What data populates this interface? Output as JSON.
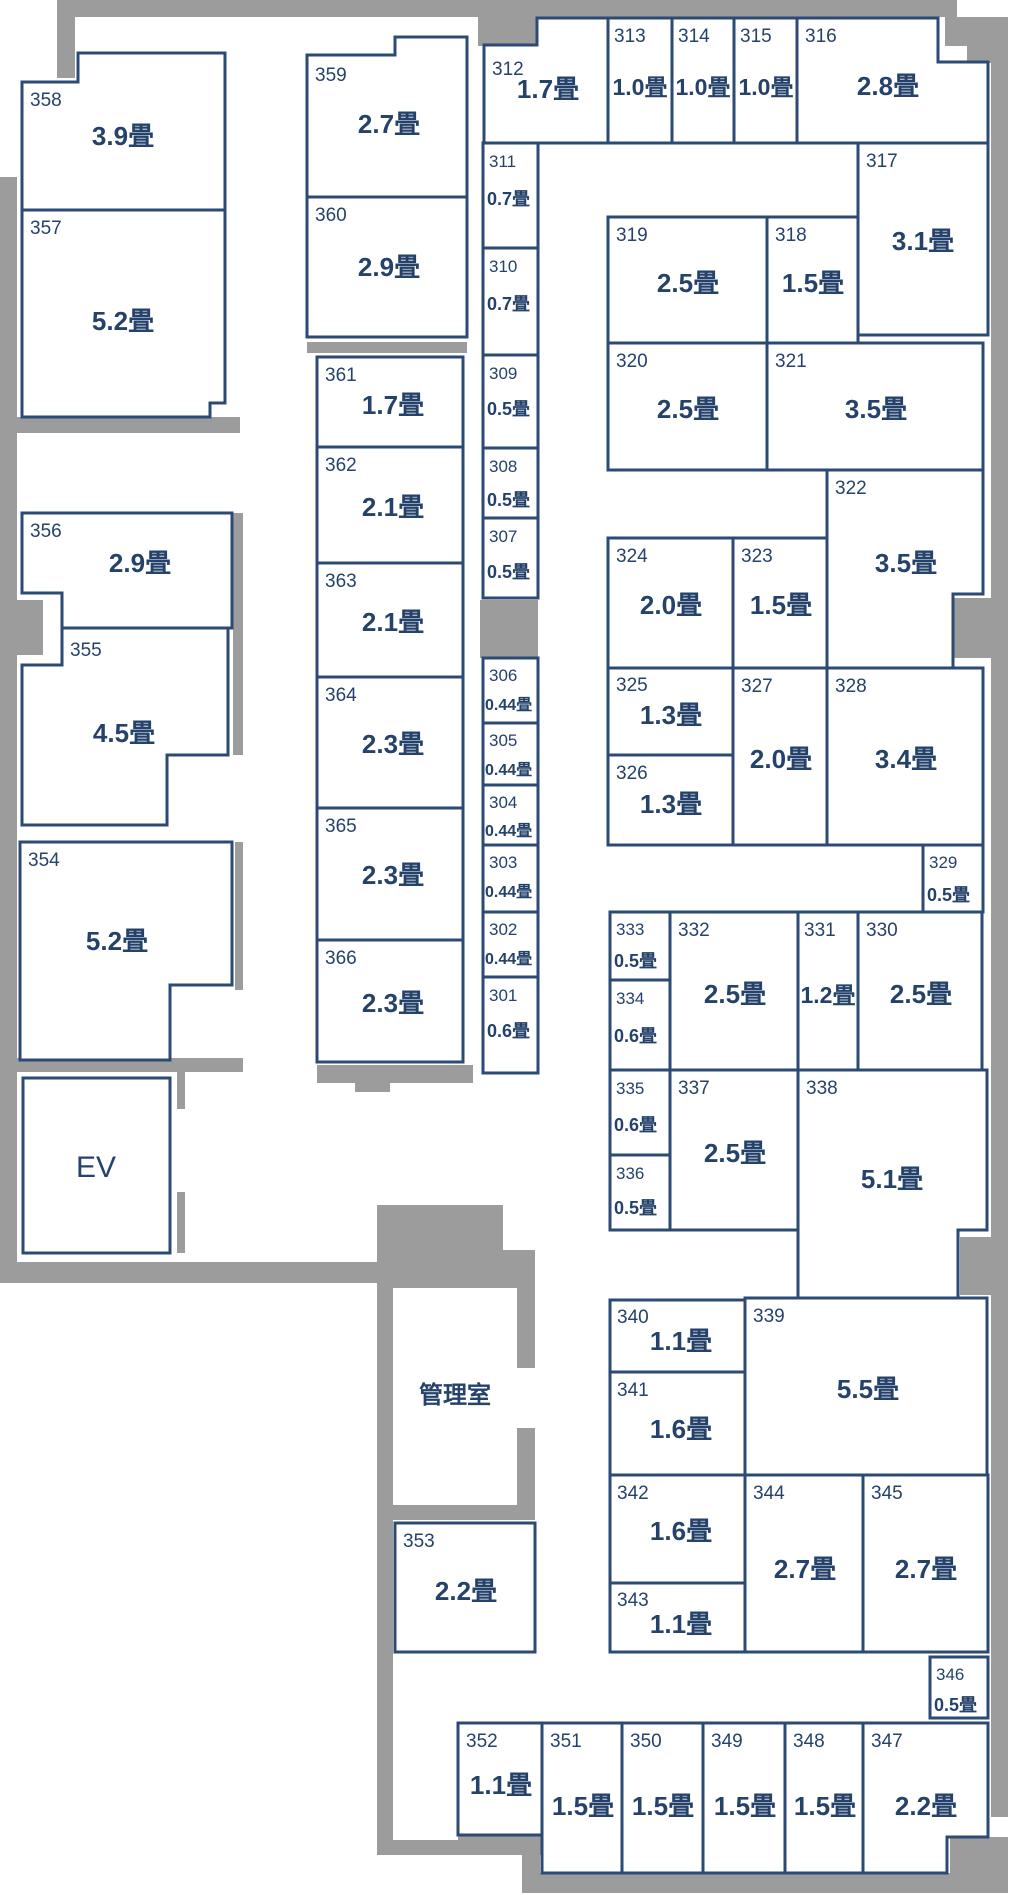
{
  "unit_suffix": "畳",
  "colors": {
    "line_navy": "#2b4a74",
    "text_navy": "#25426b",
    "wall_gray": "#9c9c9c",
    "background": "#ffffff"
  },
  "special_rooms": {
    "elevator": {
      "label": "EV"
    },
    "office": {
      "label": "管理室"
    }
  },
  "rooms": [
    {
      "id": "301",
      "size": "0.6畳"
    },
    {
      "id": "302",
      "size": "0.44畳"
    },
    {
      "id": "303",
      "size": "0.44畳"
    },
    {
      "id": "304",
      "size": "0.44畳"
    },
    {
      "id": "305",
      "size": "0.44畳"
    },
    {
      "id": "306",
      "size": "0.44畳"
    },
    {
      "id": "307",
      "size": "0.5畳"
    },
    {
      "id": "308",
      "size": "0.5畳"
    },
    {
      "id": "309",
      "size": "0.5畳"
    },
    {
      "id": "310",
      "size": "0.7畳"
    },
    {
      "id": "311",
      "size": "0.7畳"
    },
    {
      "id": "312",
      "size": "1.7畳"
    },
    {
      "id": "313",
      "size": "1.0畳"
    },
    {
      "id": "314",
      "size": "1.0畳"
    },
    {
      "id": "315",
      "size": "1.0畳"
    },
    {
      "id": "316",
      "size": "2.8畳"
    },
    {
      "id": "317",
      "size": "3.1畳"
    },
    {
      "id": "318",
      "size": "1.5畳"
    },
    {
      "id": "319",
      "size": "2.5畳"
    },
    {
      "id": "320",
      "size": "2.5畳"
    },
    {
      "id": "321",
      "size": "3.5畳"
    },
    {
      "id": "322",
      "size": "3.5畳"
    },
    {
      "id": "323",
      "size": "1.5畳"
    },
    {
      "id": "324",
      "size": "2.0畳"
    },
    {
      "id": "325",
      "size": "1.3畳"
    },
    {
      "id": "326",
      "size": "1.3畳"
    },
    {
      "id": "327",
      "size": "2.0畳"
    },
    {
      "id": "328",
      "size": "3.4畳"
    },
    {
      "id": "329",
      "size": "0.5畳"
    },
    {
      "id": "330",
      "size": "2.5畳"
    },
    {
      "id": "331",
      "size": "1.2畳"
    },
    {
      "id": "332",
      "size": "2.5畳"
    },
    {
      "id": "333",
      "size": "0.5畳"
    },
    {
      "id": "334",
      "size": "0.6畳"
    },
    {
      "id": "335",
      "size": "0.6畳"
    },
    {
      "id": "336",
      "size": "0.5畳"
    },
    {
      "id": "337",
      "size": "2.5畳"
    },
    {
      "id": "338",
      "size": "5.1畳"
    },
    {
      "id": "339",
      "size": "5.5畳"
    },
    {
      "id": "340",
      "size": "1.1畳"
    },
    {
      "id": "341",
      "size": "1.6畳"
    },
    {
      "id": "342",
      "size": "1.6畳"
    },
    {
      "id": "343",
      "size": "1.1畳"
    },
    {
      "id": "344",
      "size": "2.7畳"
    },
    {
      "id": "345",
      "size": "2.7畳"
    },
    {
      "id": "346",
      "size": "0.5畳"
    },
    {
      "id": "347",
      "size": "2.2畳"
    },
    {
      "id": "348",
      "size": "1.5畳"
    },
    {
      "id": "349",
      "size": "1.5畳"
    },
    {
      "id": "350",
      "size": "1.5畳"
    },
    {
      "id": "351",
      "size": "1.5畳"
    },
    {
      "id": "352",
      "size": "1.1畳"
    },
    {
      "id": "353",
      "size": "2.2畳"
    },
    {
      "id": "354",
      "size": "5.2畳"
    },
    {
      "id": "355",
      "size": "4.5畳"
    },
    {
      "id": "356",
      "size": "2.9畳"
    },
    {
      "id": "357",
      "size": "5.2畳"
    },
    {
      "id": "358",
      "size": "3.9畳"
    },
    {
      "id": "359",
      "size": "2.7畳"
    },
    {
      "id": "360",
      "size": "2.9畳"
    },
    {
      "id": "361",
      "size": "1.7畳"
    },
    {
      "id": "362",
      "size": "2.1畳"
    },
    {
      "id": "363",
      "size": "2.1畳"
    },
    {
      "id": "364",
      "size": "2.3畳"
    },
    {
      "id": "365",
      "size": "2.3畳"
    },
    {
      "id": "366",
      "size": "2.3畳"
    }
  ]
}
